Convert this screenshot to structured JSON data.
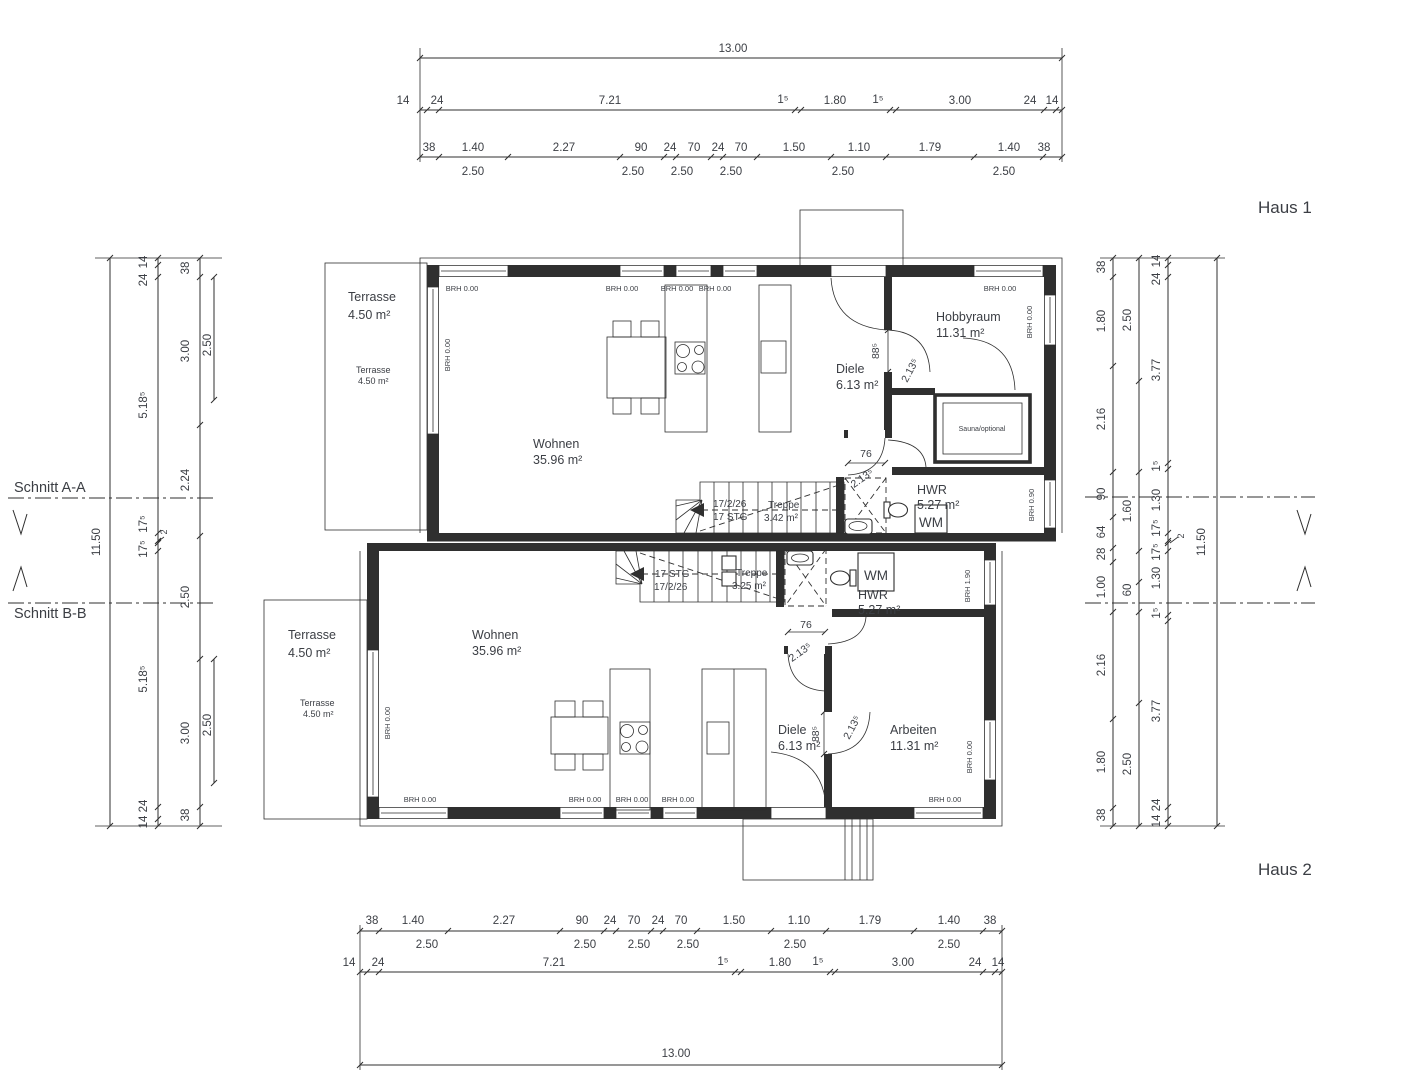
{
  "titles": {
    "haus1": "Haus 1",
    "haus2": "Haus 2"
  },
  "sections": {
    "aa": "Schnitt A-A",
    "bb": "Schnitt B-B"
  },
  "dims": {
    "total_w": "13.00",
    "total_h": "11.50",
    "sub_250": "2.50",
    "top_mid": [
      "14",
      "24",
      "7.21",
      "1⁵",
      "1.80",
      "1⁵",
      "3.00",
      "24",
      "14"
    ],
    "top_fine": [
      "38",
      "1.40",
      "2.27",
      "90",
      "24",
      "70",
      "24",
      "70",
      "1.50",
      "1.10",
      "1.79",
      "1.40",
      "38"
    ],
    "left_a": [
      "14",
      "24",
      "5.18⁵",
      "17⁵",
      "2",
      "17⁵",
      "5.18⁵",
      "24",
      "14"
    ],
    "left_b": [
      "38",
      "3.00",
      "2.24",
      "2.50",
      "3.00",
      "38"
    ],
    "right_a": [
      "38",
      "1.80",
      "2.16",
      "90",
      "64",
      "28",
      "1.00",
      "2.16",
      "1.80",
      "38"
    ],
    "right_b": [
      "2.50",
      "1.60",
      "60",
      "2.50"
    ],
    "right_c": [
      "14",
      "24",
      "3.77",
      "1⁵",
      "1.30",
      "17⁵",
      "2",
      "17⁵",
      "1.30",
      "1⁵",
      "3.77",
      "24",
      "14"
    ]
  },
  "doors": {
    "width76": "76",
    "width885": "88⁵",
    "height213": "2.13⁵"
  },
  "brh": {
    "zero": "BRH 0.00",
    "b090": "BRH 0.90",
    "b190": "BRH 1.90"
  },
  "haus1": {
    "terrasse": {
      "name": "Terrasse",
      "area": "4.50 m²"
    },
    "wohnen": {
      "name": "Wohnen",
      "area": "35.96 m²"
    },
    "diele": {
      "name": "Diele",
      "area": "6.13 m²"
    },
    "hobbyraum": {
      "name": "Hobbyraum",
      "area": "11.31 m²"
    },
    "sauna": "Sauna/optional",
    "hwr": {
      "name": "HWR",
      "area": "5.27 m²"
    },
    "wm": "WM",
    "treppe": {
      "name": "Treppe",
      "area": "3.42 m²"
    },
    "stair_note1": "17/2/26",
    "stair_note2": "17 STG"
  },
  "haus2": {
    "terrasse": {
      "name": "Terrasse",
      "area": "4.50 m²"
    },
    "wohnen": {
      "name": "Wohnen",
      "area": "35.96 m²"
    },
    "diele": {
      "name": "Diele",
      "area": "6.13 m²"
    },
    "arbeiten": {
      "name": "Arbeiten",
      "area": "11.31 m²"
    },
    "hwr": {
      "name": "HWR",
      "area": "5.27 m²"
    },
    "wm": "WM",
    "treppe": {
      "name": "Treppe",
      "area": "3.25 m²"
    },
    "stair_note1": "17 STG",
    "stair_note2": "17/2/26"
  }
}
